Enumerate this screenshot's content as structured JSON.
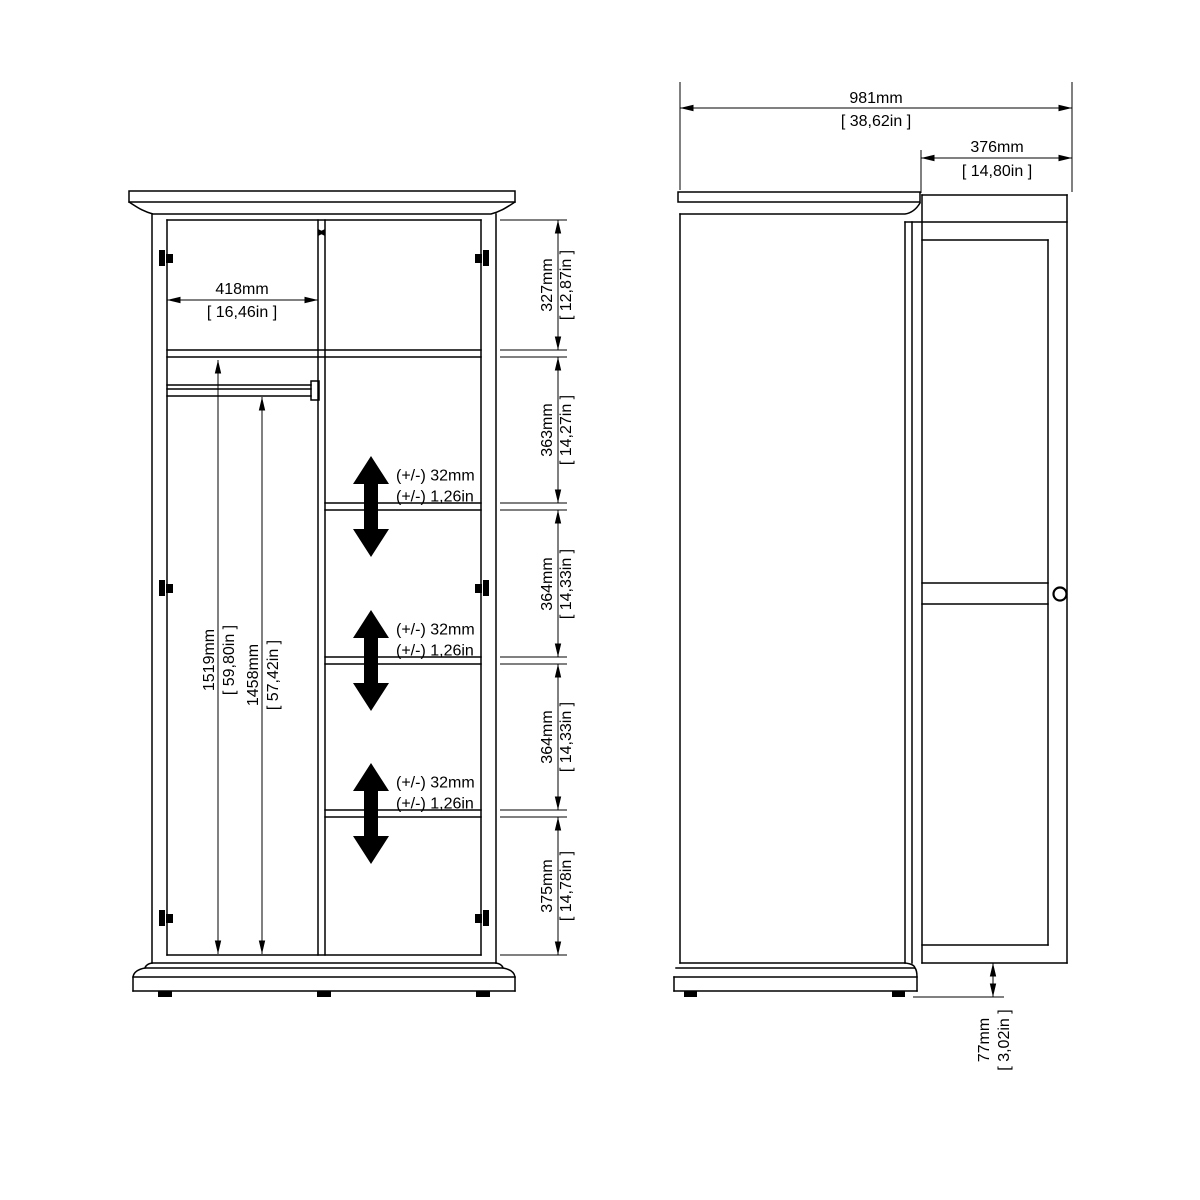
{
  "front_view": {
    "dim_opening_width": {
      "mm": "418mm",
      "in": "[ 16,46in ]"
    },
    "dim_interior_height": {
      "mm": "1519mm",
      "in": "[ 59,80in ]"
    },
    "dim_rail_height": {
      "mm": "1458mm",
      "in": "[ 57,42in ]"
    },
    "right_dims": [
      {
        "mm": "327mm",
        "in": "[ 12,87in ]"
      },
      {
        "mm": "363mm",
        "in": "[ 14,27in ]"
      },
      {
        "mm": "364mm",
        "in": "[ 14,33in ]"
      },
      {
        "mm": "364mm",
        "in": "[ 14,33in ]"
      },
      {
        "mm": "375mm",
        "in": "[ 14,78in ]"
      }
    ],
    "adjust_notes": [
      {
        "line1": "(+/-) 32mm",
        "line2": "(+/-) 1,26in"
      },
      {
        "line1": "(+/-) 32mm",
        "line2": "(+/-) 1,26in"
      },
      {
        "line1": "(+/-) 32mm",
        "line2": "(+/-) 1,26in"
      }
    ]
  },
  "side_view": {
    "dim_total": {
      "mm": "981mm",
      "in": "[ 38,62in ]"
    },
    "dim_door": {
      "mm": "376mm",
      "in": "[ 14,80in ]"
    },
    "dim_plinth": {
      "mm": "77mm",
      "in": "[ 3,02in ]"
    }
  },
  "colors": {
    "line": "#000000",
    "background": "#ffffff"
  }
}
